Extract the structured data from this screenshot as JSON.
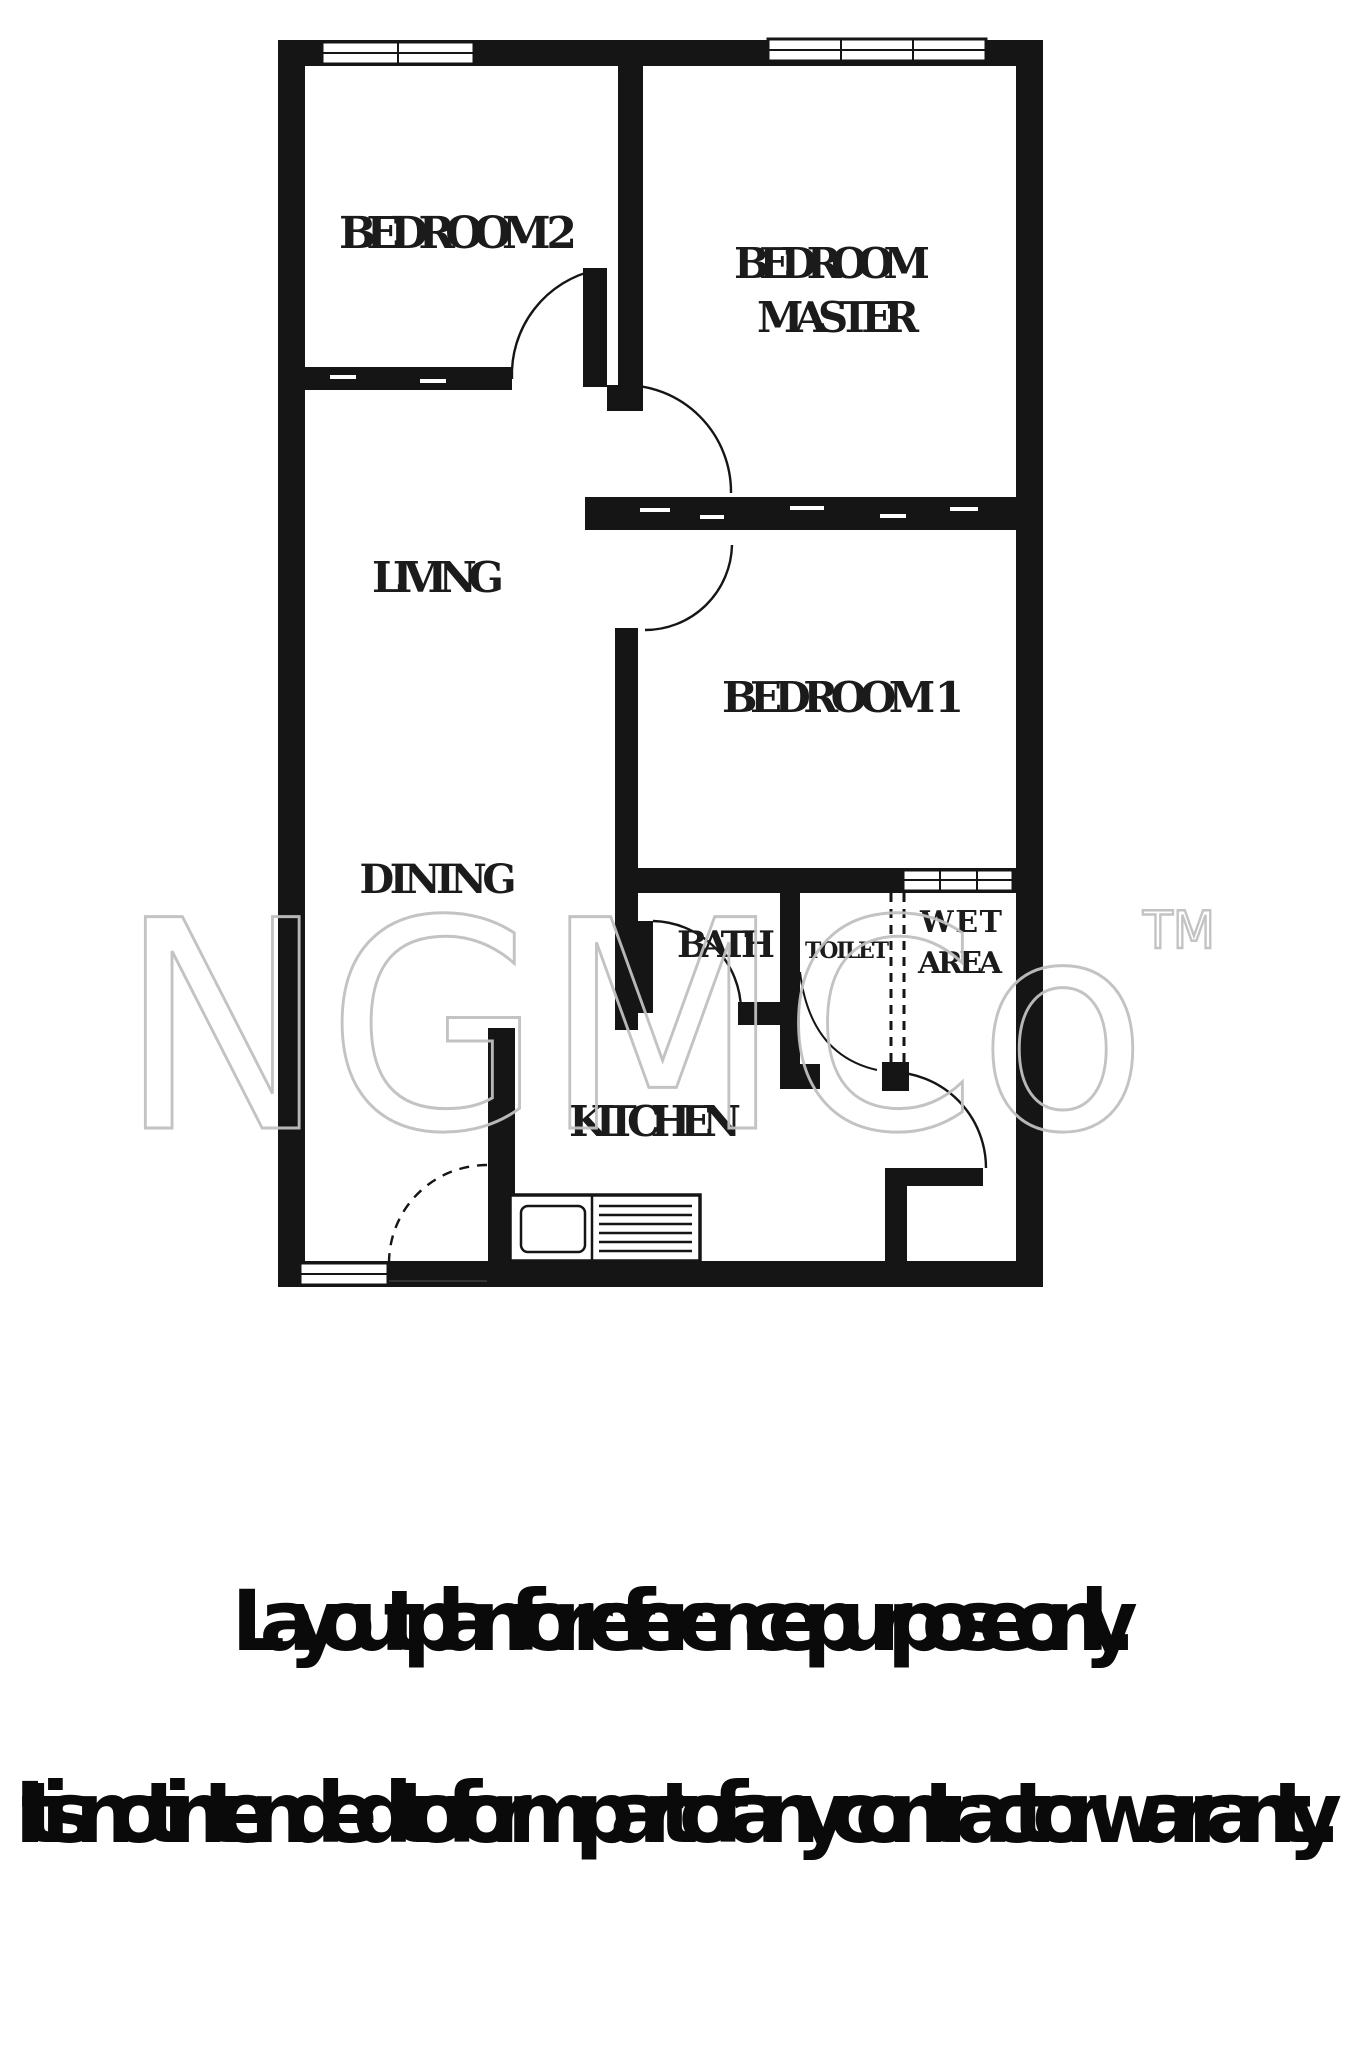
{
  "watermark": {
    "brand": "NGMCo",
    "tm": "TM"
  },
  "rooms": {
    "bedroom2": "BEDROOM 2",
    "master_line1": "BEDROOM",
    "master_line2": "MASTER",
    "living": "LIVING",
    "bedroom1": "BEDROOM 1",
    "dining": "DINING",
    "bath": "BATH",
    "toilet": "TOILET",
    "wet_line1": "WET",
    "wet_line2": "AREA",
    "kitchen": "KITCHEN"
  },
  "captions": {
    "line1": "Layout plan for reference purpose only.",
    "line2": "It is not intended to form part of any contract or warranty."
  },
  "colors": {
    "wall": "#151515",
    "label": "#1b1b1b",
    "watermark": "#c0c0c0",
    "caption": "#0a0a0a",
    "background": "#ffffff"
  }
}
